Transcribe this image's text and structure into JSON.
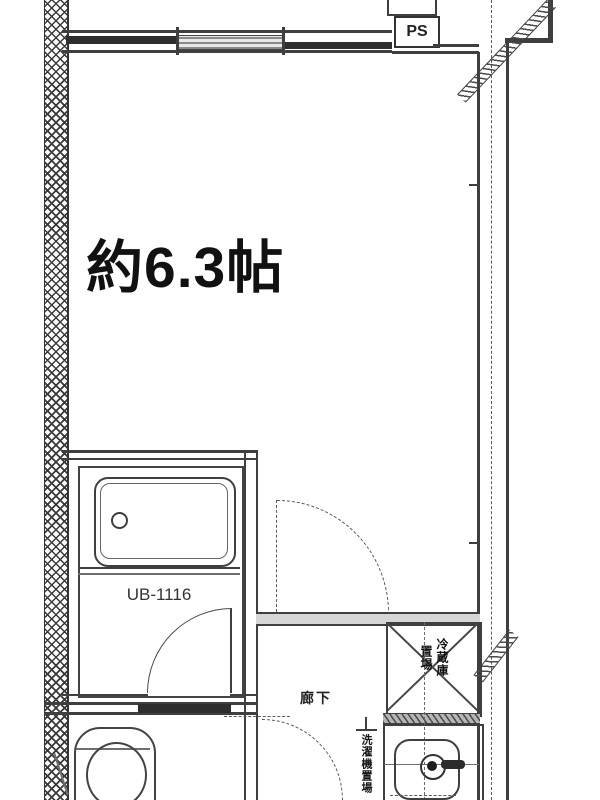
{
  "plan": {
    "title": "studio-apartment-floor-plan",
    "room": {
      "size_label": "約6.3帖"
    },
    "bath": {
      "model_label": "UB-1116"
    },
    "pipe_space": {
      "label": "PS"
    },
    "hallway": {
      "label": "廊下"
    },
    "refrigerator_space": {
      "full_label": "冷蔵庫置場",
      "column_right": "冷蔵庫",
      "column_left": "置場"
    },
    "laundry_space": {
      "label": "洗濯機置場"
    },
    "fixtures": [
      "bathtub",
      "bath-door",
      "toilet",
      "washbasin",
      "faucet",
      "refrigerator-space",
      "room-door",
      "entrance-door",
      "window",
      "exterior-hatched-wall",
      "balcony-partition"
    ],
    "colors": {
      "background": "#ffffff",
      "line": "#3f3f3f",
      "line_dark": "#2e2e2e",
      "wall_fill": "#d6d6d6",
      "text": "#111111"
    }
  }
}
